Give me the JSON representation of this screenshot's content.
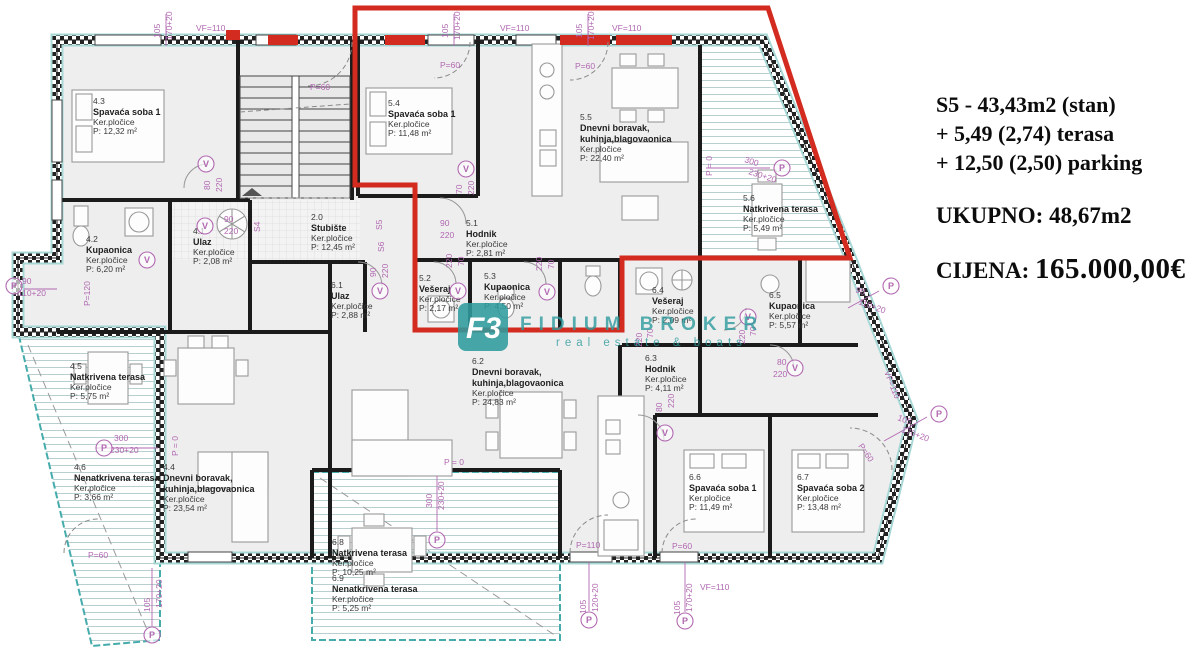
{
  "listing": {
    "line1": "S5 - 43,43m2 (stan)",
    "line2": "+ 5,49 (2,74) terasa",
    "line3": "+ 12,50 (2,50) parking",
    "total": "UKUPNO: 48,67m2",
    "price_label": "CIJENA:",
    "price_value": "165.000,00€"
  },
  "watermark": {
    "logo": "F3",
    "brand": "FIDIUM BROKER",
    "tagline": "real estate & boats"
  },
  "rooms": [
    {
      "id": "4.3",
      "name": "Spavaća soba 1",
      "floor": "Ker.pločice",
      "area": "P: 12,32 m²"
    },
    {
      "id": "4.2",
      "name": "Kupaonica",
      "floor": "Ker.pločice",
      "area": "P: 6,20 m²"
    },
    {
      "id": "4.1",
      "name": "Ulaz",
      "floor": "Ker.pločice",
      "area": "P: 2,08 m²"
    },
    {
      "id": "2.0",
      "name": "Stubište",
      "floor": "Ker.pločice",
      "area": "P: 12,45 m²"
    },
    {
      "id": "5.4",
      "name": "Spavaća soba 1",
      "floor": "Ker.pločice",
      "area": "P: 11,48 m²"
    },
    {
      "id": "5.5",
      "name": "Dnevni boravak,",
      "name2": "kuhinja,blagovaonica",
      "floor": "Ker.pločice",
      "area": "P: 22,40 m²"
    },
    {
      "id": "5.1",
      "name": "Hodnik",
      "floor": "Ker.pločice",
      "area": "P: 2,81 m²"
    },
    {
      "id": "5.2",
      "name": "Vešeraj",
      "floor": "Ker.pločice",
      "area": "P: 2,17 m²"
    },
    {
      "id": "5.3",
      "name": "Kupaonica",
      "floor": "Ker.pločice",
      "area": "P: 4,50 m²"
    },
    {
      "id": "5.6",
      "name": "Natkrivena terasa",
      "floor": "Ker.pločice",
      "area": "P: 5,49 m²"
    },
    {
      "id": "6.1",
      "name": "Ulaz",
      "floor": "Ker.pločice",
      "area": "P: 2,88 m²"
    },
    {
      "id": "6.4",
      "name": "Vešeraj",
      "floor": "Ker.pločice",
      "area": "P: 2,09 m²"
    },
    {
      "id": "6.5",
      "name": "Kupaonica",
      "floor": "Ker.pločice",
      "area": "P: 5,57 m²"
    },
    {
      "id": "6.2",
      "name": "Dnevni boravak,",
      "name2": "kuhinja,blagovaonica",
      "floor": "Ker.pločice",
      "area": "P: 24,83 m²"
    },
    {
      "id": "6.3",
      "name": "Hodnik",
      "floor": "Ker.pločice",
      "area": "P: 4,11 m²"
    },
    {
      "id": "4.5",
      "name": "Natkrivena terasa",
      "floor": "Ker.pločice",
      "area": "P: 5,75 m²"
    },
    {
      "id": "4.6",
      "name": "Nenatkrivena terasa",
      "floor": "Ker.pločice",
      "area": "P: 3,66 m²"
    },
    {
      "id": "4.4",
      "name": "Dnevni boravak,",
      "name2": "kuhinja,blagovaonica",
      "floor": "Ker.pločice",
      "area": "P: 23,54 m²"
    },
    {
      "id": "6.6",
      "name": "Spavaća soba 1",
      "floor": "Ker.pločice",
      "area": "P: 11,49 m²"
    },
    {
      "id": "6.7",
      "name": "Spavaća soba 2",
      "floor": "Ker.pločice",
      "area": "P: 13,48 m²"
    },
    {
      "id": "6.8",
      "name": "Natkrivena terasa",
      "floor": "Ker.pločice",
      "area": "P: 10,25 m²"
    },
    {
      "id": "6.9",
      "name": "Nenatkrivena terasa",
      "floor": "Ker.pločice",
      "area": "P: 5,25 m²"
    }
  ],
  "dims": [
    {
      "t": "105"
    },
    {
      "t": "170+20"
    },
    {
      "t": "VF=110"
    },
    {
      "t": "P=60"
    },
    {
      "t": "105"
    },
    {
      "t": "170+20"
    },
    {
      "t": "P=60"
    },
    {
      "t": "VF=110"
    },
    {
      "t": "105"
    },
    {
      "t": "170+20"
    },
    {
      "t": "VF=110"
    },
    {
      "t": "P=60"
    },
    {
      "t": "80"
    },
    {
      "t": "220"
    },
    {
      "t": "90"
    },
    {
      "t": "220"
    },
    {
      "t": "S4"
    },
    {
      "t": "S5"
    },
    {
      "t": "S6"
    },
    {
      "t": "90"
    },
    {
      "t": "220"
    },
    {
      "t": "70"
    },
    {
      "t": "220"
    },
    {
      "t": "90"
    },
    {
      "t": "220"
    },
    {
      "t": "220"
    },
    {
      "t": "70"
    },
    {
      "t": "220"
    },
    {
      "t": "70"
    },
    {
      "t": "70"
    },
    {
      "t": "220"
    },
    {
      "t": "70"
    },
    {
      "t": "220"
    },
    {
      "t": "90"
    },
    {
      "t": "110+20"
    },
    {
      "t": "P=120"
    },
    {
      "t": "300"
    },
    {
      "t": "230+20"
    },
    {
      "t": "P = 0"
    },
    {
      "t": "300"
    },
    {
      "t": "230+20"
    },
    {
      "t": "P = 0"
    },
    {
      "t": "P=110"
    },
    {
      "t": "P=60"
    },
    {
      "t": "105"
    },
    {
      "t": "120+20"
    },
    {
      "t": "105"
    },
    {
      "t": "170+20"
    },
    {
      "t": "VF=110"
    },
    {
      "t": "90"
    },
    {
      "t": "110+20"
    },
    {
      "t": "VF=110"
    },
    {
      "t": "105"
    },
    {
      "t": "170+20"
    },
    {
      "t": "P=60"
    },
    {
      "t": "80"
    },
    {
      "t": "220"
    },
    {
      "t": "80"
    },
    {
      "t": "220"
    },
    {
      "t": "P = 0"
    },
    {
      "t": "300"
    },
    {
      "t": "230+20"
    },
    {
      "t": "105"
    },
    {
      "t": "170+20"
    },
    {
      "t": "P=60"
    }
  ],
  "circles": [
    {
      "t": "V"
    },
    {
      "t": "V"
    },
    {
      "t": "V"
    },
    {
      "t": "V"
    },
    {
      "t": "V"
    },
    {
      "t": "V"
    },
    {
      "t": "V"
    },
    {
      "t": "V"
    },
    {
      "t": "V"
    },
    {
      "t": "V"
    },
    {
      "t": "P"
    },
    {
      "t": "P"
    },
    {
      "t": "P"
    },
    {
      "t": "P"
    },
    {
      "t": "P"
    },
    {
      "t": "P"
    },
    {
      "t": "P"
    },
    {
      "t": "P"
    },
    {
      "t": "P"
    }
  ]
}
